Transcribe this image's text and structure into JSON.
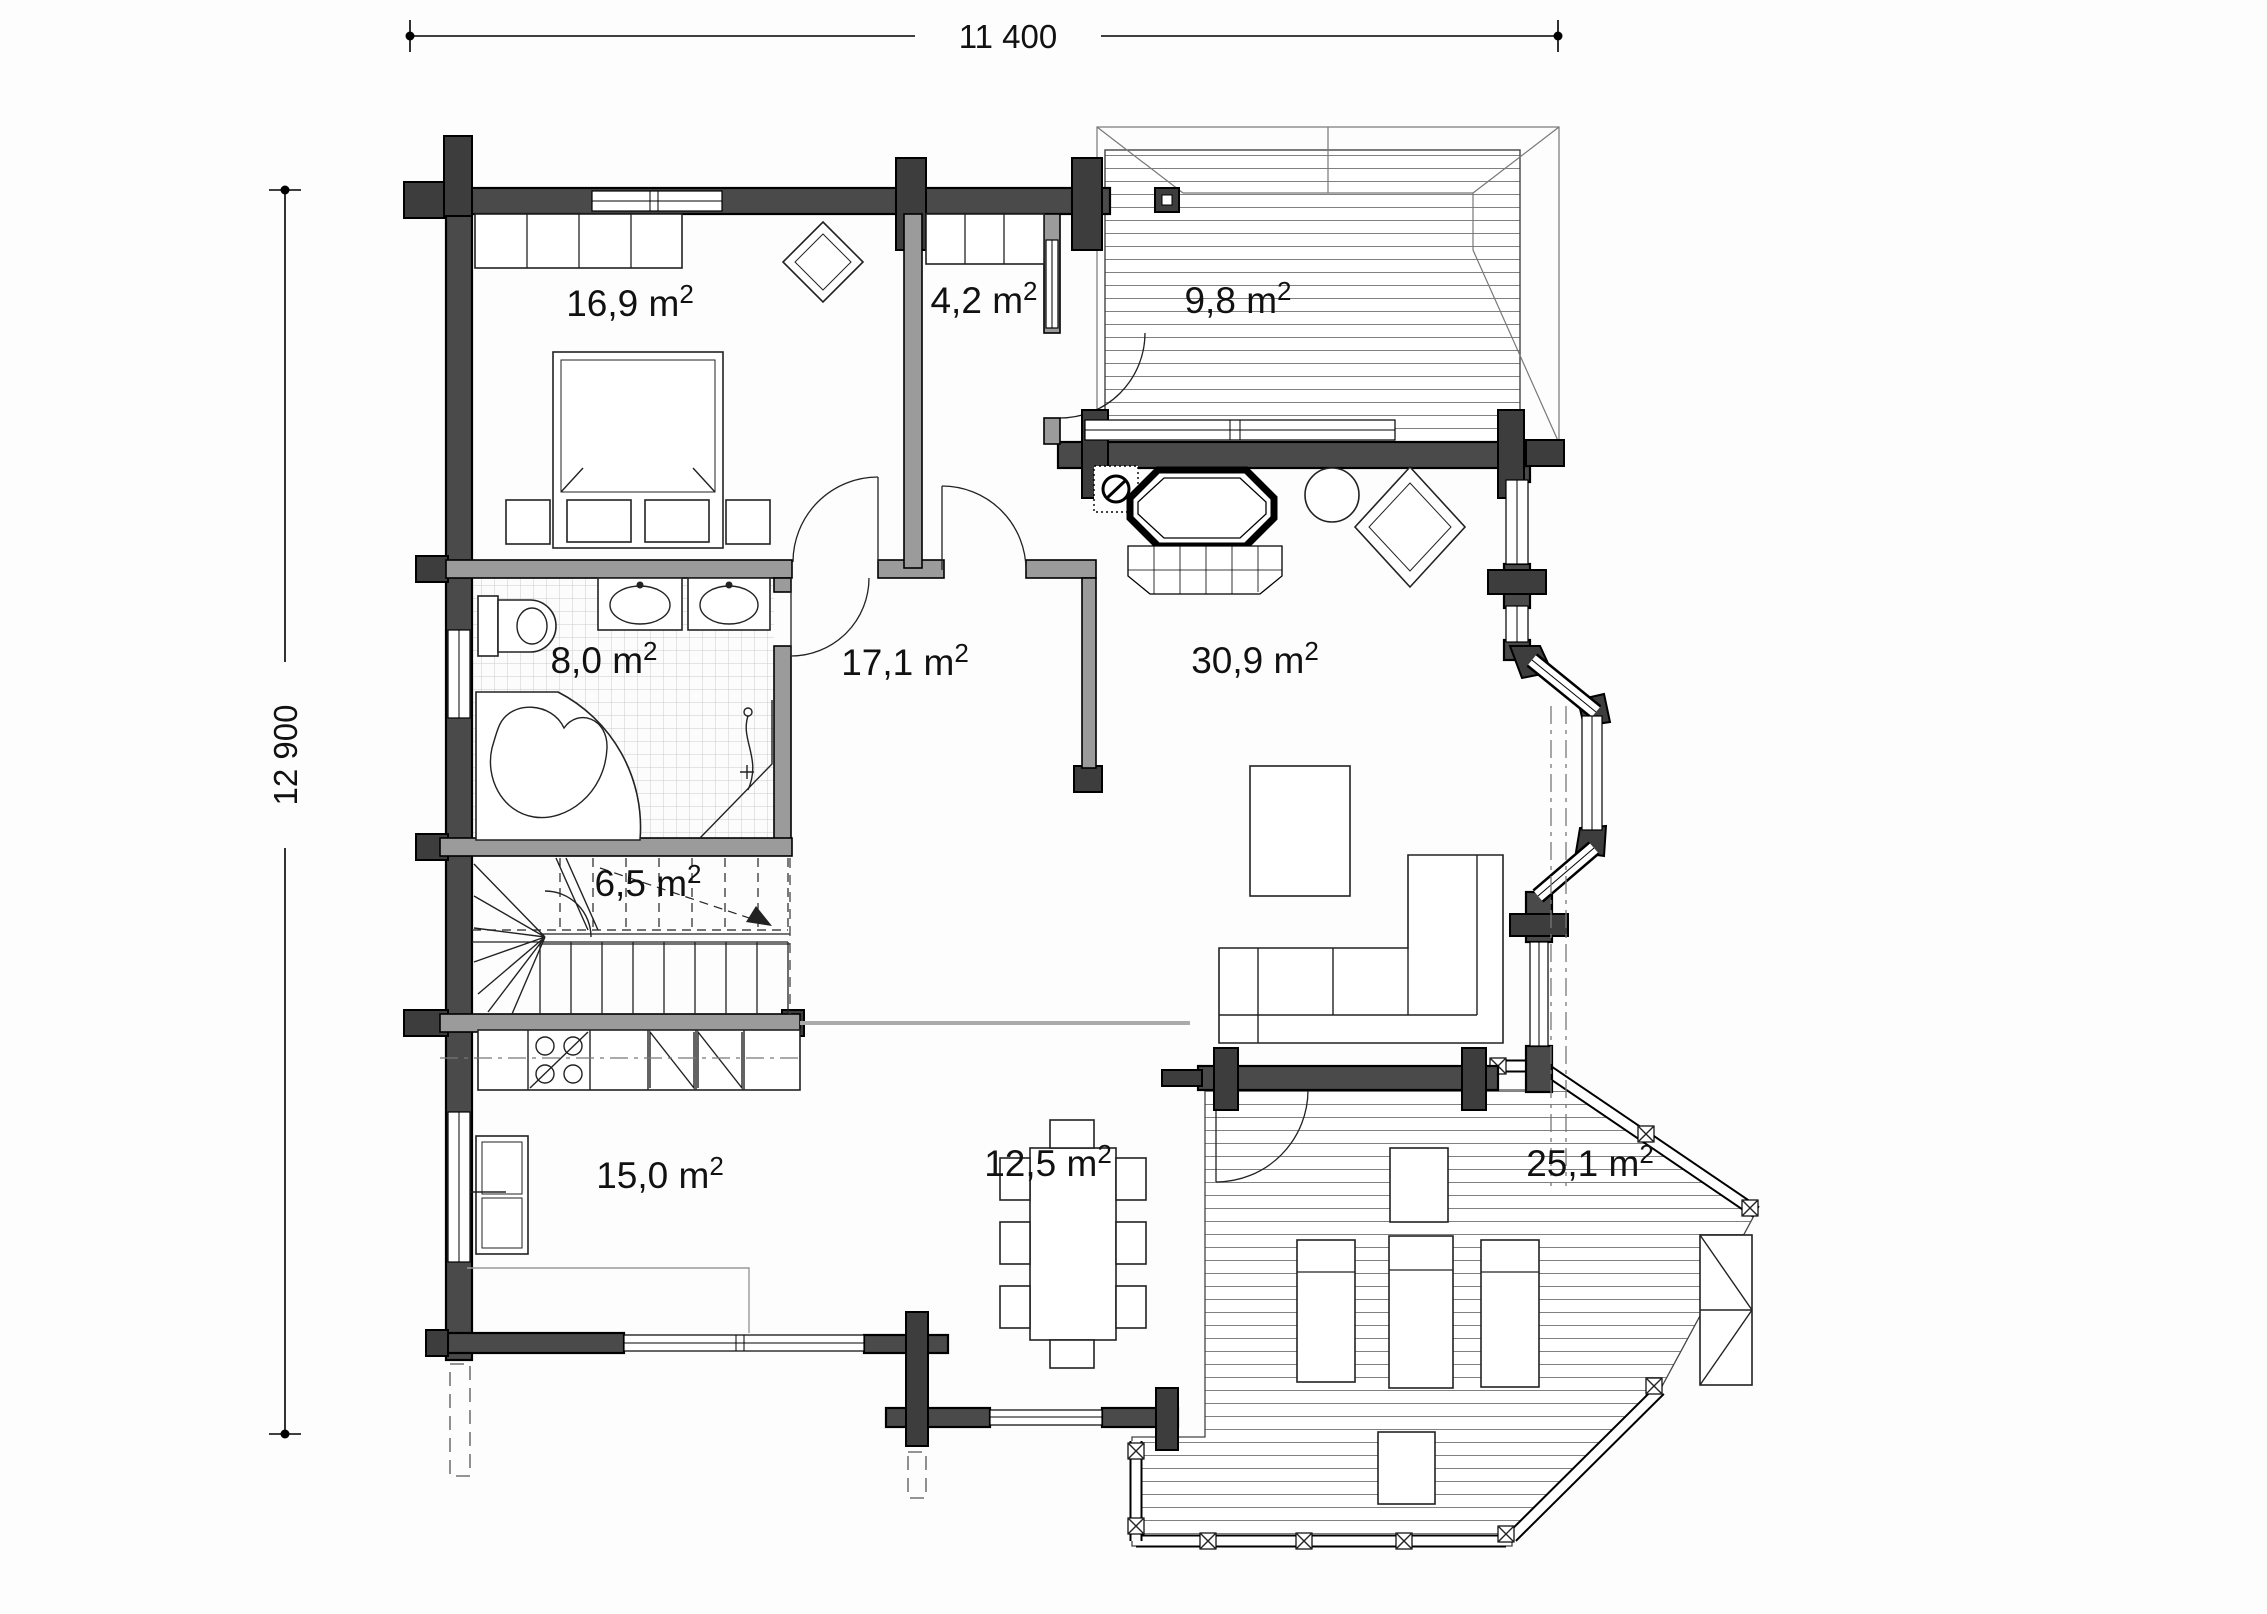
{
  "plan": {
    "dimensions": {
      "width": "11 400",
      "height": "12 900"
    },
    "unit": {
      "m": " m",
      "sup": "2"
    },
    "rooms": [
      {
        "id": "bedroom",
        "area": "16,9"
      },
      {
        "id": "entry",
        "area": "4,2"
      },
      {
        "id": "deck-top",
        "area": "9,8"
      },
      {
        "id": "bathroom",
        "area": "8,0"
      },
      {
        "id": "hall",
        "area": "17,1"
      },
      {
        "id": "living",
        "area": "30,9"
      },
      {
        "id": "stairs",
        "area": "6,5"
      },
      {
        "id": "kitchen",
        "area": "15,0"
      },
      {
        "id": "dining",
        "area": "12,5"
      },
      {
        "id": "deck-bottom",
        "area": "25,1"
      }
    ]
  }
}
